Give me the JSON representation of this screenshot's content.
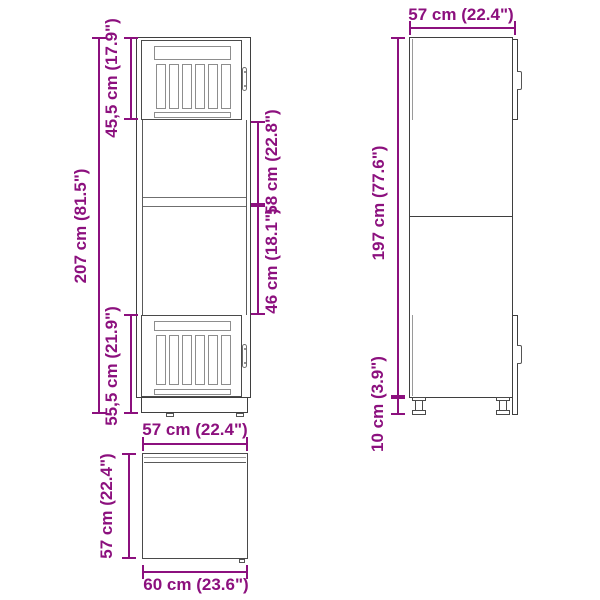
{
  "title": "Kitchen cabinet dimension diagram",
  "colors": {
    "dimension_accent": "#8C107E",
    "drawing_outline": "#3f3f3f"
  },
  "front_view": {
    "total_height_label": "207 cm (81.5\")",
    "upper_door_label": "45,5 cm (17.9\")",
    "upper_middle_label": "58 cm (22.8\")",
    "lower_middle_label": "46 cm (18.1\")",
    "lower_door_label": "55,5 cm (21.9\")",
    "width_label": "57 cm (22.4\")"
  },
  "side_view": {
    "depth_label": "57 cm (22.4\")",
    "body_height_label": "197 cm (77.6\")",
    "feet_height_label": "10 cm (3.9\")"
  },
  "base_side_view": {
    "height_label": "57 cm (22.4\")",
    "depth_label": "60 cm (23.6\")"
  }
}
